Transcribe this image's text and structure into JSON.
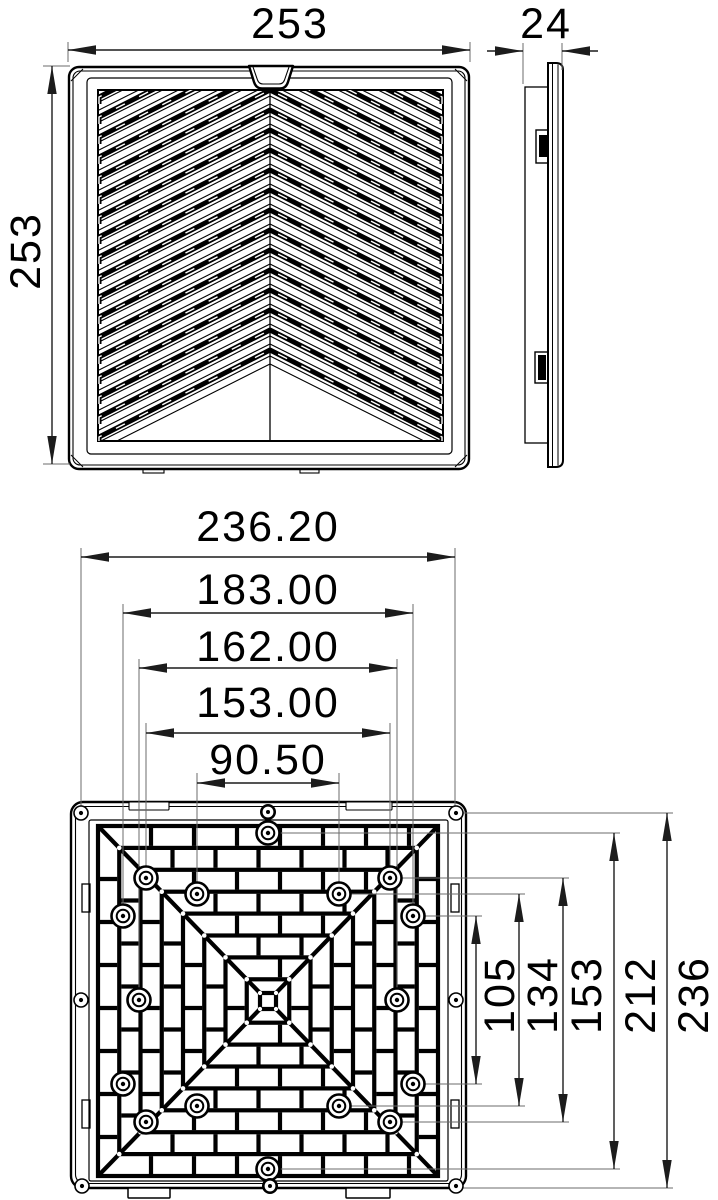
{
  "page": {
    "background": "#ffffff",
    "kind": "technical-drawing"
  },
  "colors": {
    "line": "#000000",
    "dim_line": "#1c1c1c",
    "extension_line": "#6b6b6b",
    "text": "#000000",
    "background": "#ffffff"
  },
  "views": {
    "front": {
      "width": "253",
      "height": "253"
    },
    "side": {
      "depth": "24"
    },
    "rear": {
      "width_dims": [
        "236.20",
        "183.00",
        "162.00",
        "153.00",
        "90.50"
      ],
      "height_dims": [
        "105",
        "134",
        "153",
        "212",
        "236"
      ]
    }
  }
}
